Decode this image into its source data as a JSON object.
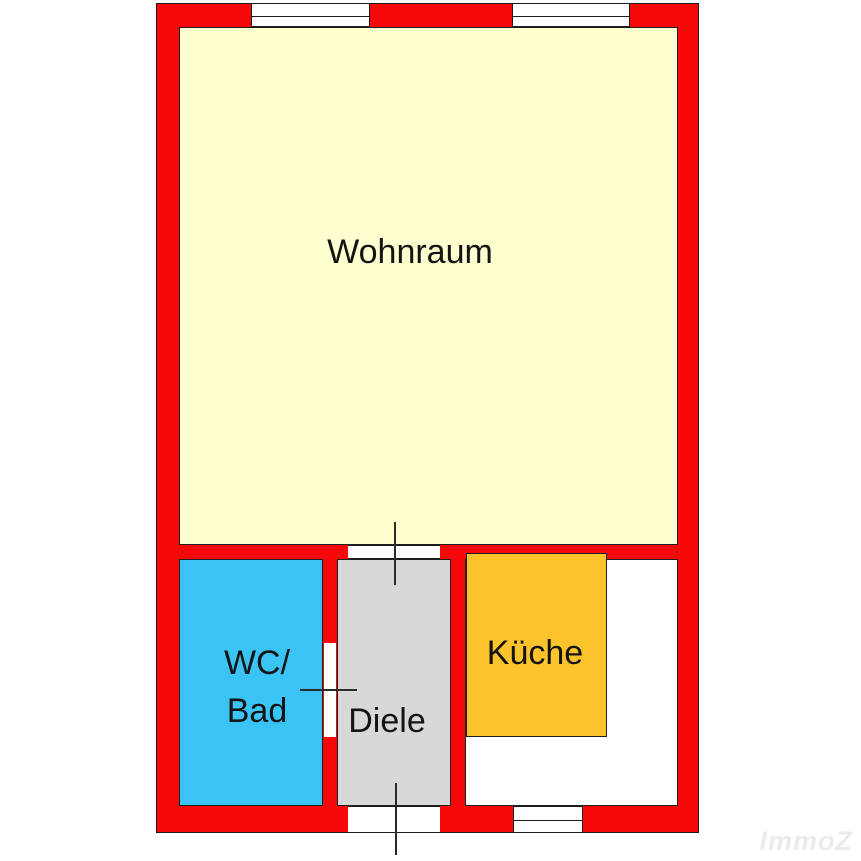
{
  "floorplan": {
    "rooms": {
      "wohnraum": {
        "label": "Wohnraum",
        "color": "#ffffcf"
      },
      "wc_bad": {
        "label_line1": "WC/",
        "label_line2": "Bad",
        "color": "#3ac4f5"
      },
      "diele": {
        "label": "Diele",
        "color": "#d8d8d8"
      },
      "kueche": {
        "label": "Küche",
        "color": "#fcc32d",
        "room_fill": "#ffffff"
      }
    },
    "walls": {
      "color": "#f70808",
      "outline_color": "#1a1a1a"
    },
    "windows": {
      "count": 3,
      "fill": "#ffffff"
    },
    "doors": {
      "count": 3
    }
  },
  "watermark": {
    "text": "ImmoZ",
    "color": "#ebebeb"
  }
}
